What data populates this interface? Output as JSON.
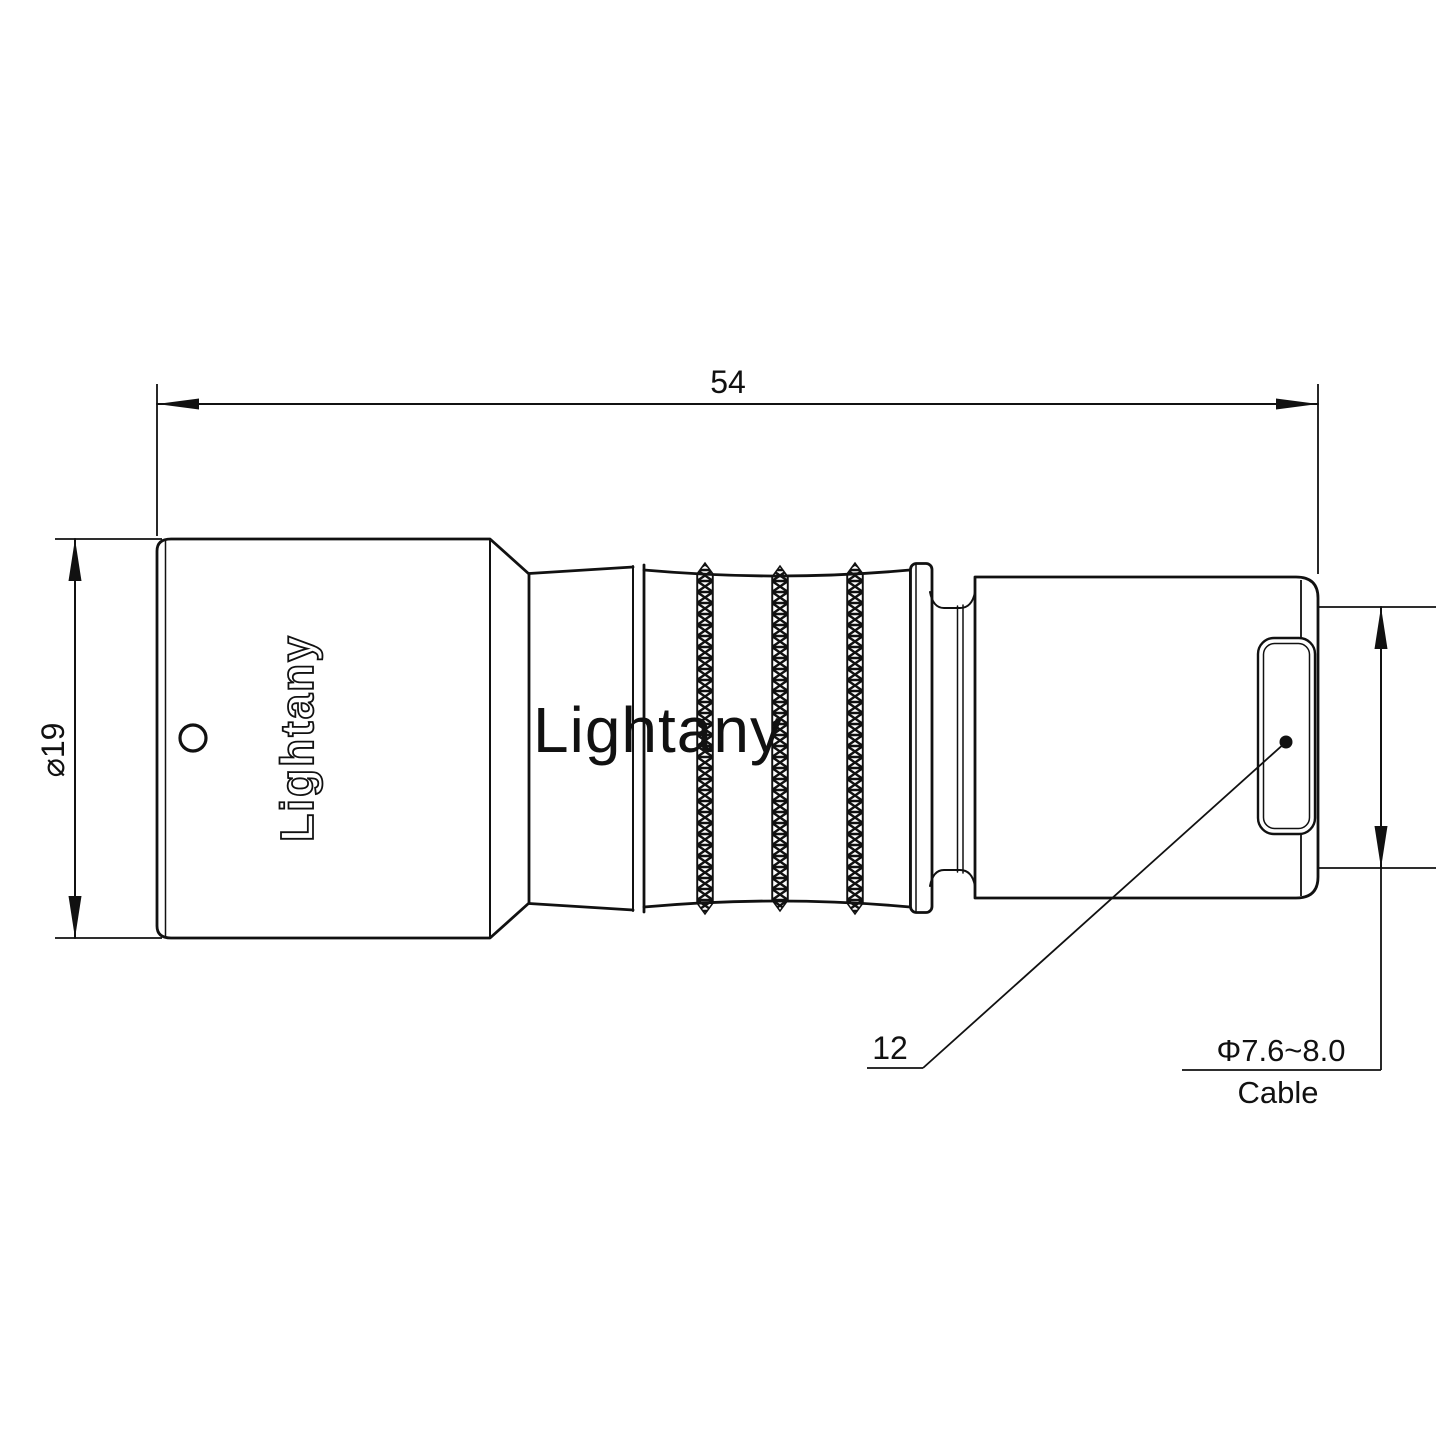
{
  "page": {
    "background": "#ffffff"
  },
  "drawing": {
    "line_color": "#111111",
    "watermark": {
      "text": "Lightany",
      "color": "#f0b2b2"
    },
    "brand": {
      "text": "Lightany"
    },
    "dims": {
      "overall_length": "54",
      "front_diameter": "⌀19",
      "rear_reference": "12",
      "cable_diameter": "Φ7.6~8.0",
      "cable_label": "Cable"
    }
  }
}
